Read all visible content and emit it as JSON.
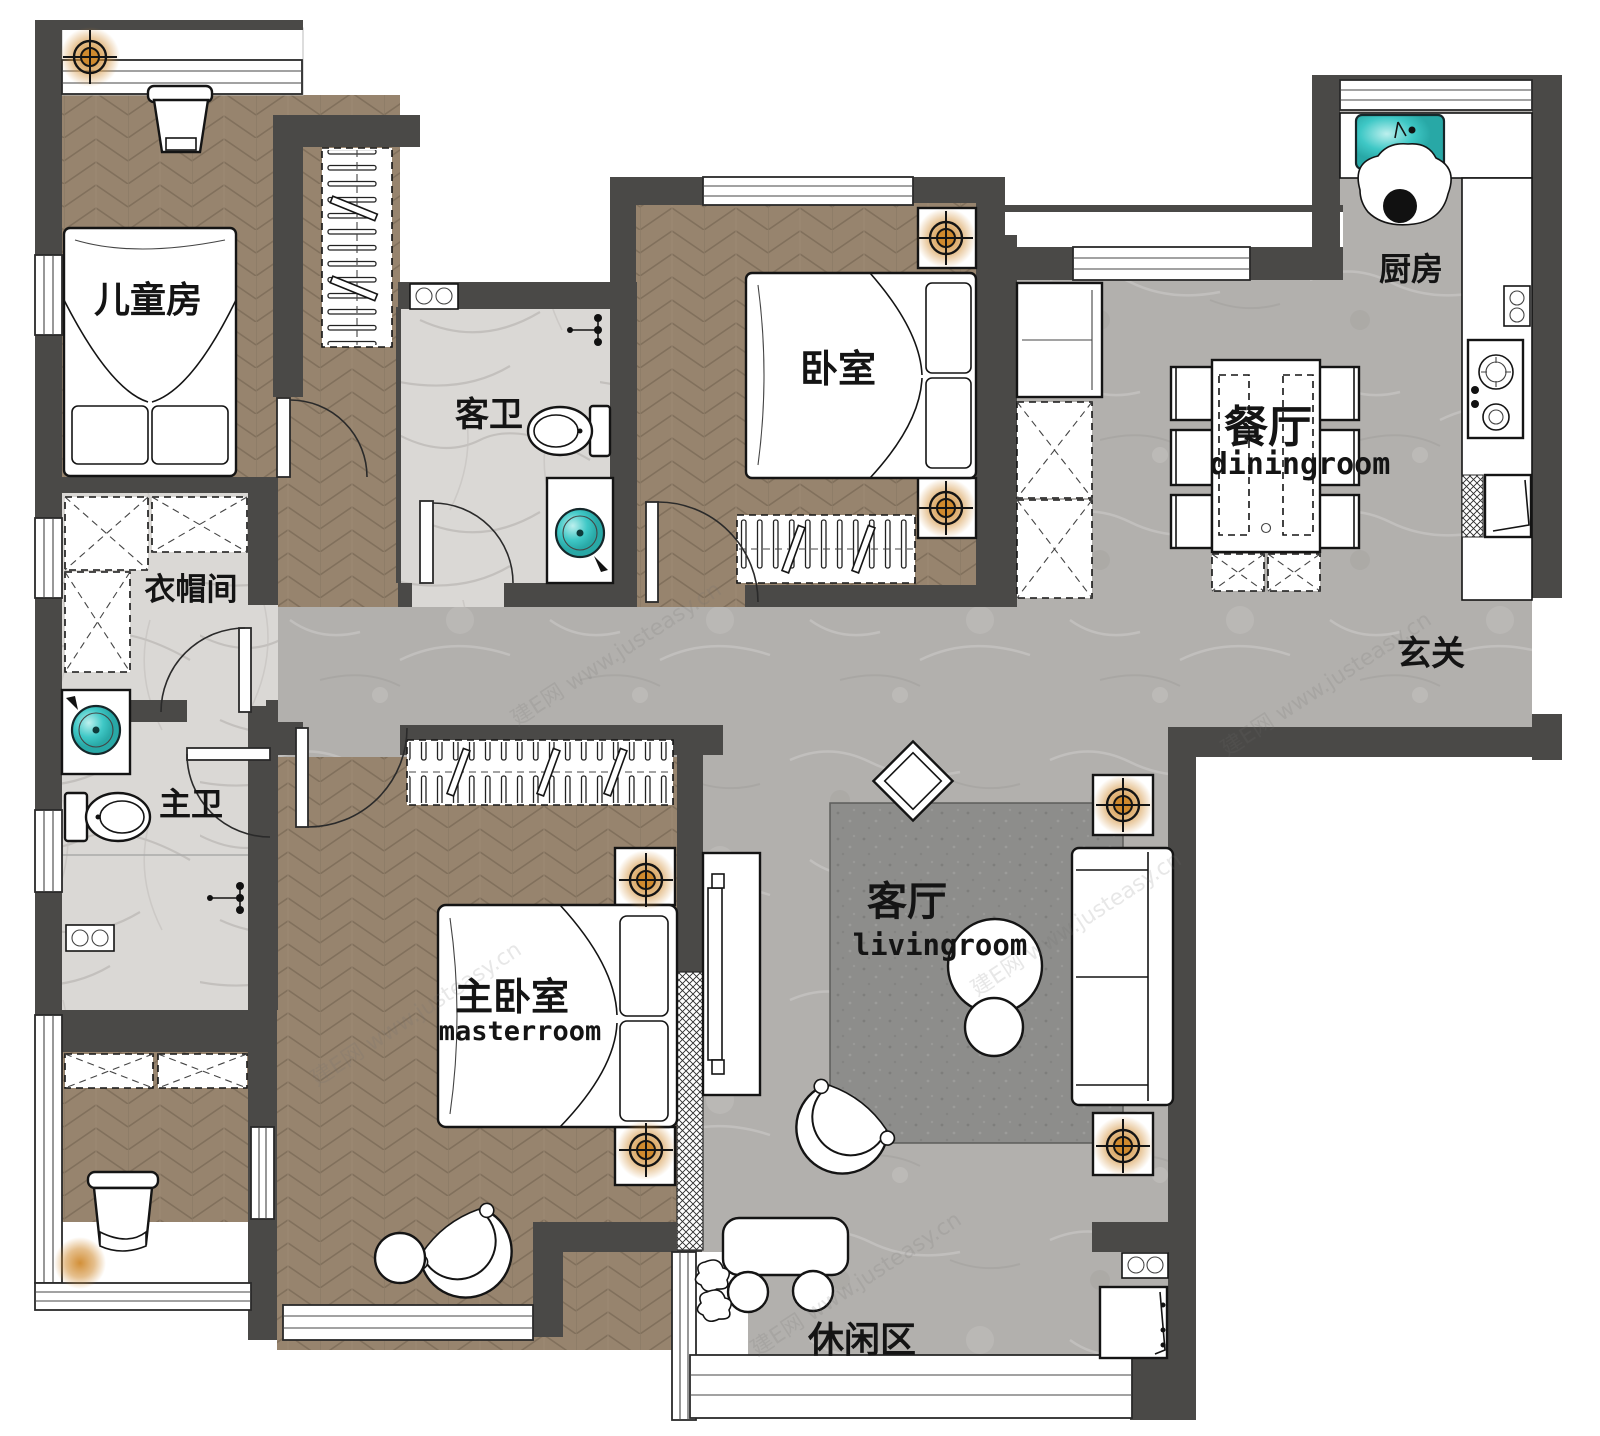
{
  "title": "apartment-floor-plan",
  "colors": {
    "wall": "#4a4947",
    "wood_floor": "#97846e",
    "tile_floor": "#b2b0ad",
    "marble_floor": "#dad8d5",
    "rug": "#8d8d8b",
    "sink_teal": "#3fc8c6",
    "light_glow_orange": "#d08a2e",
    "text": "#141414"
  },
  "rooms": {
    "childrens_room": {
      "label": "儿童房"
    },
    "guest_bath": {
      "label": "客卫"
    },
    "bedroom": {
      "label": "卧室"
    },
    "kitchen": {
      "label": "厨房"
    },
    "dining": {
      "label": "餐厅",
      "label_en": "diningroom"
    },
    "foyer": {
      "label": "玄关"
    },
    "cloakroom": {
      "label": "衣帽间"
    },
    "master_bath": {
      "label": "主卫"
    },
    "master_bedroom": {
      "label": "主卧室",
      "label_en": "masterroom"
    },
    "living": {
      "label": "客厅",
      "label_en": "livingroom"
    },
    "leisure": {
      "label": "休闲区"
    }
  },
  "lights": [
    {
      "name": "ceiling-light-childrens",
      "x": 90,
      "y": 57
    },
    {
      "name": "ceiling-light-bedroom-n",
      "x": 946,
      "y": 238
    },
    {
      "name": "ceiling-light-bedroom-s",
      "x": 946,
      "y": 508
    },
    {
      "name": "ceiling-light-master-n",
      "x": 646,
      "y": 880
    },
    {
      "name": "ceiling-light-master-s",
      "x": 646,
      "y": 1150
    },
    {
      "name": "ceiling-light-living-n",
      "x": 1123,
      "y": 805
    },
    {
      "name": "ceiling-light-living-s",
      "x": 1123,
      "y": 1146
    }
  ],
  "glows": [
    {
      "name": "balcony-lamp-glow",
      "x": 80,
      "y": 1263
    }
  ],
  "watermark": {
    "text": "建E网 www.justeasy.cn",
    "spots": [
      {
        "x": 620,
        "y": 660,
        "r": -33
      },
      {
        "x": 1080,
        "y": 930,
        "r": -33
      },
      {
        "x": 860,
        "y": 1290,
        "r": -33
      },
      {
        "x": 1330,
        "y": 690,
        "r": -33
      },
      {
        "x": 420,
        "y": 1020,
        "r": -33
      }
    ]
  }
}
